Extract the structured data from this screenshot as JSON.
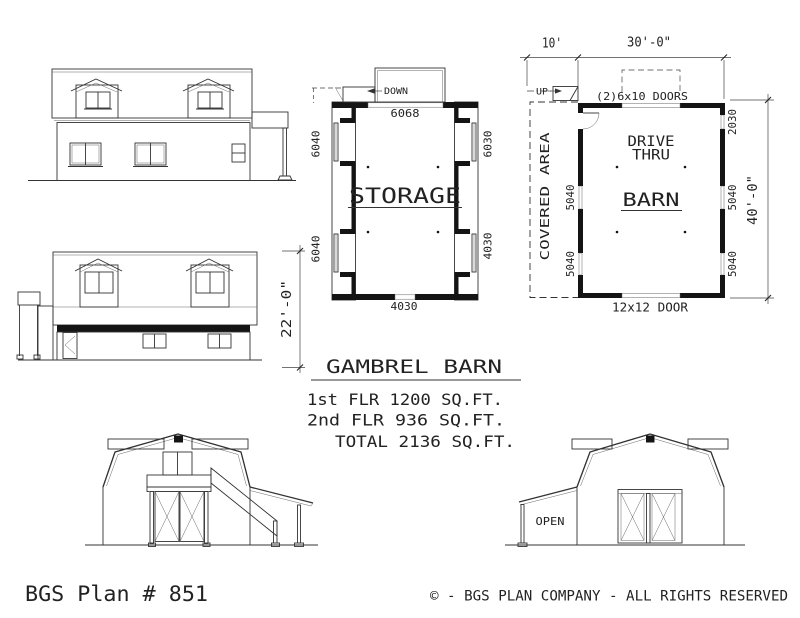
{
  "document": {
    "plan_number": "BGS Plan # 851",
    "copyright": "© - BGS PLAN COMPANY - ALL RIGHTS RESERVED"
  },
  "summary": {
    "title": "GAMBREL BARN",
    "line1": "1st FLR 1200 SQ.FT.",
    "line2": "2nd FLR  936 SQ.FT.",
    "line3": "TOTAL 2136 SQ.FT."
  },
  "storage_plan": {
    "room_label": "STORAGE",
    "stair_label": "DOWN",
    "dim_top": "6068",
    "dim_bottom": "4030",
    "dim_left_upper": "6040",
    "dim_left_lower": "6040",
    "dim_right_upper": "6030",
    "dim_right_lower": "4030"
  },
  "barn_plan": {
    "room_label": "BARN",
    "drive_thru_line1": "DRIVE",
    "drive_thru_line2": "THRU",
    "covered_area_label": "COVERED AREA",
    "stair_label": "UP",
    "doors_top_label": "(2)6x10 DOORS",
    "door_bottom_label": "12x12 DOOR",
    "dim_left_top": "10'",
    "dim_top": "30'-0\"",
    "dim_right": "40'-0\"",
    "win_right_upper": "2030",
    "win_right_mid": "5040",
    "win_right_lower": "5040",
    "win_left_mid": "5040",
    "win_left_lower": "5040"
  },
  "side_elevation": {
    "height_dim": "22'-0\""
  },
  "rear_elevation": {
    "open_label": "OPEN"
  },
  "colors": {
    "line": "#333333",
    "poche": "#141414",
    "text": "#222222",
    "background": "#ffffff"
  }
}
